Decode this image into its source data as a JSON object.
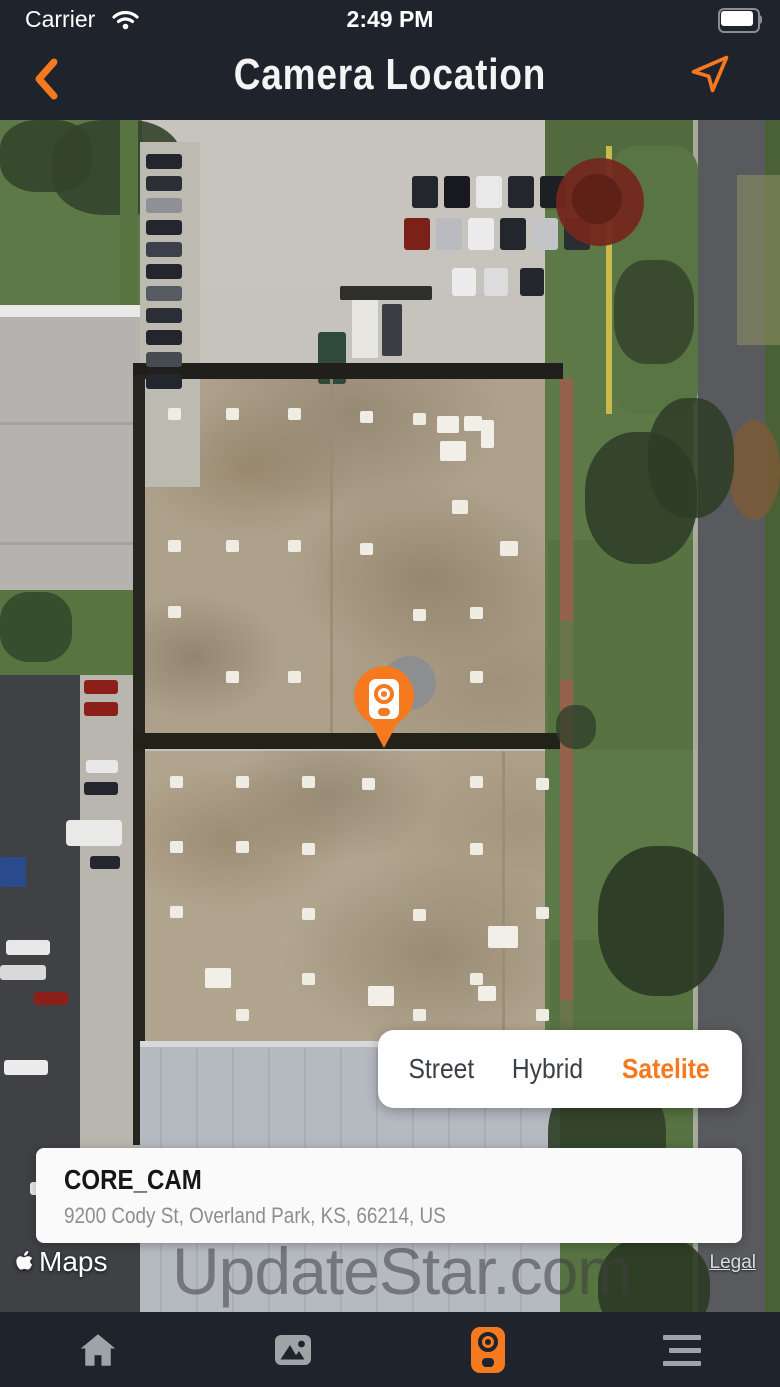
{
  "status_bar": {
    "carrier": "Carrier",
    "time": "2:49 PM"
  },
  "header": {
    "title": "Camera Location"
  },
  "map": {
    "provider_label": "Maps",
    "legal_label": "Legal",
    "watermark": "UpdateStar.com",
    "type_selector": {
      "options": [
        {
          "label": "Street",
          "active": false
        },
        {
          "label": "Hybrid",
          "active": false
        },
        {
          "label": "Satelite",
          "active": true
        }
      ]
    }
  },
  "info_card": {
    "name": "CORE_CAM",
    "address": "9200 Cody St, Overland Park, KS, 66214, US"
  },
  "tab_bar": {
    "items": [
      {
        "icon": "home-icon",
        "active": false
      },
      {
        "icon": "gallery-icon",
        "active": false
      },
      {
        "icon": "camera-icon",
        "active": true
      },
      {
        "icon": "menu-icon",
        "active": false
      }
    ]
  },
  "colors": {
    "accent": "#F5791F",
    "bar_background": "#1E232C",
    "inactive_icon": "#9EA3A8"
  }
}
